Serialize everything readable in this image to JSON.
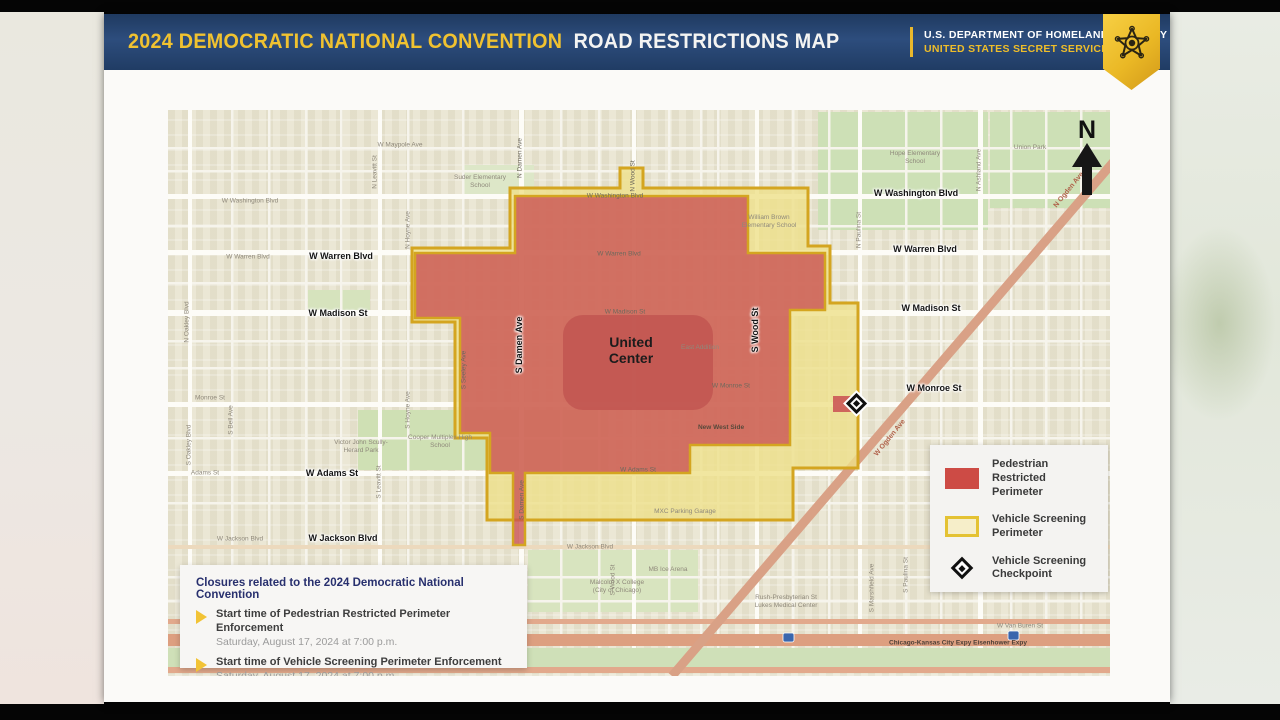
{
  "header": {
    "title_gold": "2024 DEMOCRATIC NATIONAL CONVENTION",
    "title_white": "ROAD RESTRICTIONS MAP",
    "agency_line1": "U.S. DEPARTMENT OF HOMELAND SECURITY",
    "agency_line2": "UNITED STATES SECRET SERVICE",
    "badge_icon": "secret-service-star-badge",
    "colors": {
      "bar_navy": "#2d4d7d",
      "gold": "#f0c230"
    }
  },
  "map": {
    "north_label": "N",
    "venue": {
      "line1": "United",
      "line2": "Center"
    },
    "zone_colors": {
      "pedestrian_red": "#cd4b45",
      "vehicle_yellow": "#efe186",
      "border_gold": "#d4a520"
    },
    "labels": [
      {
        "text": "W Washington Blvd",
        "x": 748,
        "y": 83,
        "cls": "lbl-bold"
      },
      {
        "text": "W Warren Blvd",
        "x": 757,
        "y": 139,
        "cls": "lbl-bold"
      },
      {
        "text": "W Madison St",
        "x": 763,
        "y": 198,
        "cls": "lbl-bold"
      },
      {
        "text": "W Monroe St",
        "x": 766,
        "y": 278,
        "cls": "lbl-bold"
      },
      {
        "text": "W Warren Blvd",
        "x": 173,
        "y": 146,
        "cls": "lbl-bold"
      },
      {
        "text": "W Madison St",
        "x": 170,
        "y": 203,
        "cls": "lbl-bold"
      },
      {
        "text": "W Adams St",
        "x": 164,
        "y": 363,
        "cls": "lbl-bold"
      },
      {
        "text": "W Jackson Blvd",
        "x": 175,
        "y": 428,
        "cls": "lbl-bold"
      },
      {
        "text": "S Damen Ave",
        "x": 351,
        "y": 235,
        "rot": -90,
        "cls": "lbl-bold"
      },
      {
        "text": "S Wood St",
        "x": 587,
        "y": 220,
        "rot": -90,
        "cls": "lbl-bold"
      },
      {
        "text": "W Maypole Ave",
        "x": 232,
        "y": 35,
        "cls": "lbl-small"
      },
      {
        "text": "W Washington Blvd",
        "x": 82,
        "y": 91,
        "cls": "lbl-small"
      },
      {
        "text": "W Warren Blvd",
        "x": 80,
        "y": 147,
        "cls": "lbl-small"
      },
      {
        "text": "Monroe St",
        "x": 42,
        "y": 288,
        "cls": "lbl-small"
      },
      {
        "text": "Adams St",
        "x": 37,
        "y": 363,
        "cls": "lbl-small"
      },
      {
        "text": "W Jackson Blvd",
        "x": 72,
        "y": 429,
        "cls": "lbl-small"
      },
      {
        "text": "W Jackson Blvd",
        "x": 422,
        "y": 437,
        "cls": "lbl-small"
      },
      {
        "text": "W Van Buren St",
        "x": 197,
        "y": 512,
        "cls": "lbl-small"
      },
      {
        "text": "W Van Buren St",
        "x": 852,
        "y": 516,
        "cls": "lbl-small"
      },
      {
        "text": "Chicago-Kansas City Expy Eisenhower Expy",
        "x": 790,
        "y": 533,
        "cls": "lbl-expwy"
      },
      {
        "text": "W Washington Blvd",
        "x": 447,
        "y": 86,
        "cls": "lbl-small-dark"
      },
      {
        "text": "W Warren Blvd",
        "x": 451,
        "y": 144,
        "cls": "lbl-small-dark"
      },
      {
        "text": "W Madison St",
        "x": 457,
        "y": 202,
        "cls": "lbl-small-dark"
      },
      {
        "text": "W Monroe St",
        "x": 563,
        "y": 276,
        "cls": "lbl-small-dark"
      },
      {
        "text": "W Adams St",
        "x": 470,
        "y": 360,
        "cls": "lbl-small-dark"
      },
      {
        "text": "N Leavitt St",
        "x": 207,
        "y": 62,
        "rot": -90,
        "cls": "lbl-small"
      },
      {
        "text": "N Oakley Blvd",
        "x": 19,
        "y": 212,
        "rot": -90,
        "cls": "lbl-small"
      },
      {
        "text": "S Oakley Blvd",
        "x": 21,
        "y": 335,
        "rot": -90,
        "cls": "lbl-small"
      },
      {
        "text": "S Bell Ave",
        "x": 63,
        "y": 310,
        "rot": -90,
        "cls": "lbl-small"
      },
      {
        "text": "S Leavitt St",
        "x": 211,
        "y": 372,
        "rot": -90,
        "cls": "lbl-small"
      },
      {
        "text": "S Hoyne Ave",
        "x": 240,
        "y": 300,
        "rot": -90,
        "cls": "lbl-small"
      },
      {
        "text": "N Hoyne Ave",
        "x": 240,
        "y": 120,
        "rot": -90,
        "cls": "lbl-small"
      },
      {
        "text": "N Damen Ave",
        "x": 352,
        "y": 48,
        "rot": -90,
        "cls": "lbl-small-dark"
      },
      {
        "text": "S Seeley Ave",
        "x": 296,
        "y": 260,
        "rot": -90,
        "cls": "lbl-small-dark"
      },
      {
        "text": "N Wood St",
        "x": 465,
        "y": 66,
        "rot": -90,
        "cls": "lbl-small-dark"
      },
      {
        "text": "S Wood St",
        "x": 445,
        "y": 470,
        "rot": -90,
        "cls": "lbl-small"
      },
      {
        "text": "N Paulina St",
        "x": 691,
        "y": 120,
        "rot": -90,
        "cls": "lbl-small"
      },
      {
        "text": "S Paulina St",
        "x": 738,
        "y": 465,
        "rot": -90,
        "cls": "lbl-small"
      },
      {
        "text": "S Marshfield Ave",
        "x": 704,
        "y": 478,
        "rot": -90,
        "cls": "lbl-small"
      },
      {
        "text": "N Ashland Ave",
        "x": 811,
        "y": 60,
        "rot": -90,
        "cls": "lbl-small"
      },
      {
        "text": "S Damen Ave",
        "x": 354,
        "y": 390,
        "rot": -90,
        "cls": "lbl-small-dark"
      },
      {
        "text": "N Ogden Ave",
        "x": 901,
        "y": 80,
        "rot": -51,
        "cls": "lbl-ogden"
      },
      {
        "text": "W Ogden Ave",
        "x": 722,
        "y": 328,
        "rot": -51,
        "cls": "lbl-ogden"
      },
      {
        "text": "Union Park",
        "x": 862,
        "y": 38,
        "cls": "lbl-poi"
      },
      {
        "text": "Hope Elementary School",
        "x": 747,
        "y": 48,
        "cls": "lbl-poi"
      },
      {
        "text": "Suder Elementary School",
        "x": 312,
        "y": 72,
        "cls": "lbl-poi"
      },
      {
        "text": "William Brown Elementary School",
        "x": 601,
        "y": 112,
        "cls": "lbl-poi"
      },
      {
        "text": "East Addition",
        "x": 532,
        "y": 238,
        "cls": "lbl-poi"
      },
      {
        "text": "New West Side",
        "x": 553,
        "y": 318,
        "cls": "lbl-zone"
      },
      {
        "text": "MXC Parking Garage",
        "x": 517,
        "y": 402,
        "cls": "lbl-poi"
      },
      {
        "text": "MB Ice Arena",
        "x": 500,
        "y": 460,
        "cls": "lbl-poi"
      },
      {
        "text": "Malcolm X College (City of Chicago)",
        "x": 449,
        "y": 477,
        "cls": "lbl-poi"
      },
      {
        "text": "Rush-Presbyterian St Lukes Medical Center",
        "x": 618,
        "y": 492,
        "cls": "lbl-poi"
      },
      {
        "text": "Victor John Scully-Herard Park",
        "x": 193,
        "y": 337,
        "cls": "lbl-poi"
      },
      {
        "text": "Cooper Multiplex High School",
        "x": 272,
        "y": 332,
        "cls": "lbl-poi"
      }
    ]
  },
  "legend": {
    "items": [
      {
        "label": "Pedestrian Restricted Perimeter",
        "swatch": "red-fill"
      },
      {
        "label": "Vehicle Screening Perimeter",
        "swatch": "yellow-outline"
      },
      {
        "label": "Vehicle Screening Checkpoint",
        "swatch": "checkpoint-diamond"
      }
    ]
  },
  "infobox": {
    "title": "Closures related to the 2024 Democratic National Convention",
    "items": [
      {
        "label": "Start time of Pedestrian Restricted Perimeter Enforcement",
        "sublabel": "Saturday, August 17, 2024 at 7:00 p.m."
      },
      {
        "label": "Start time of Vehicle Screening Perimeter Enforcement",
        "sublabel": "Saturday, August 17, 2024 at 7:00 p.m."
      }
    ]
  }
}
